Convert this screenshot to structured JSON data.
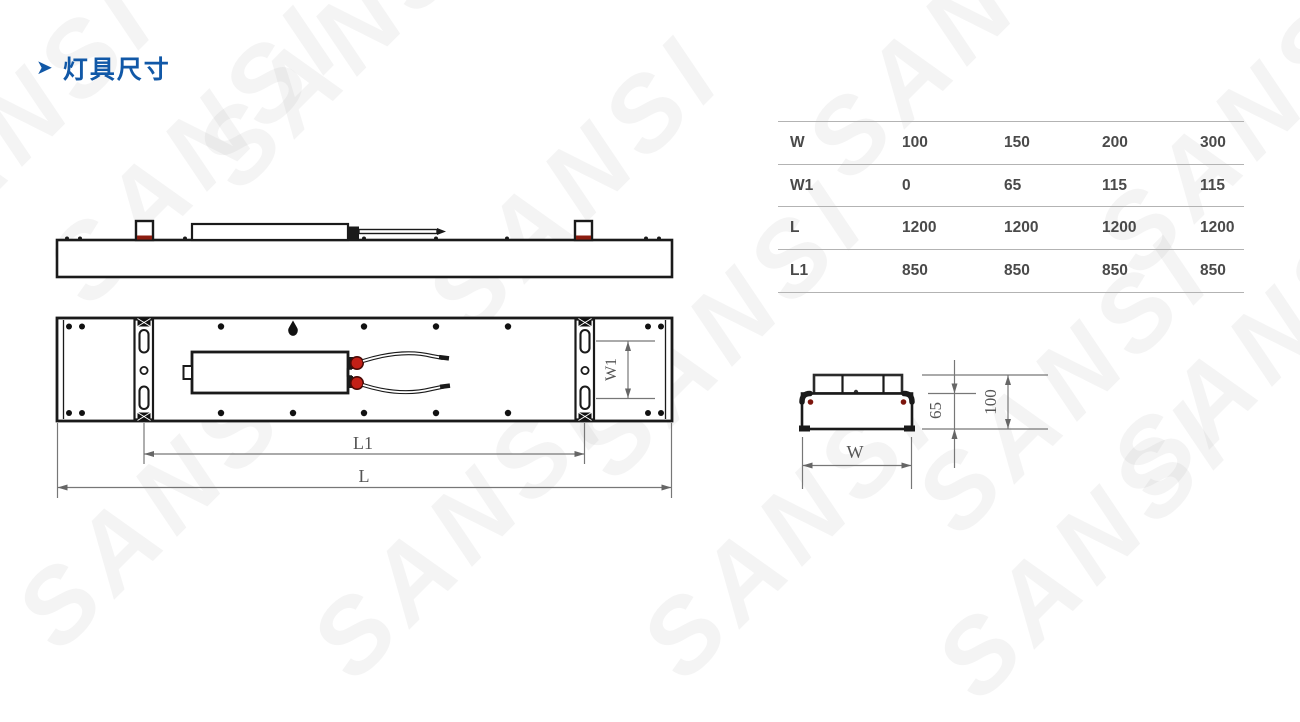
{
  "title": {
    "arrow": "➤",
    "text": "灯具尺寸"
  },
  "watermark": {
    "text": "SANSI"
  },
  "dimension_table": {
    "rows": [
      {
        "label": "W",
        "values": [
          "100",
          "150",
          "200",
          "300"
        ]
      },
      {
        "label": "W1",
        "values": [
          "0",
          "65",
          "115",
          "115"
        ]
      },
      {
        "label": "L",
        "values": [
          "1200",
          "1200",
          "1200",
          "1200"
        ]
      },
      {
        "label": "L1",
        "values": [
          "850",
          "850",
          "850",
          "850"
        ]
      }
    ]
  },
  "drawing": {
    "top_view": {
      "w1_label": "W1",
      "l1_label": "L1",
      "l_label": "L"
    },
    "end_view": {
      "body_height": "65",
      "total_height": "100",
      "width_label": "W"
    }
  },
  "colors": {
    "accent_blue": "#1158a7",
    "line_black": "#1a1a1a",
    "dim_gray": "#6b6b6b",
    "connector_red": "#c32017",
    "mark_dark_red": "#8c1d10"
  }
}
